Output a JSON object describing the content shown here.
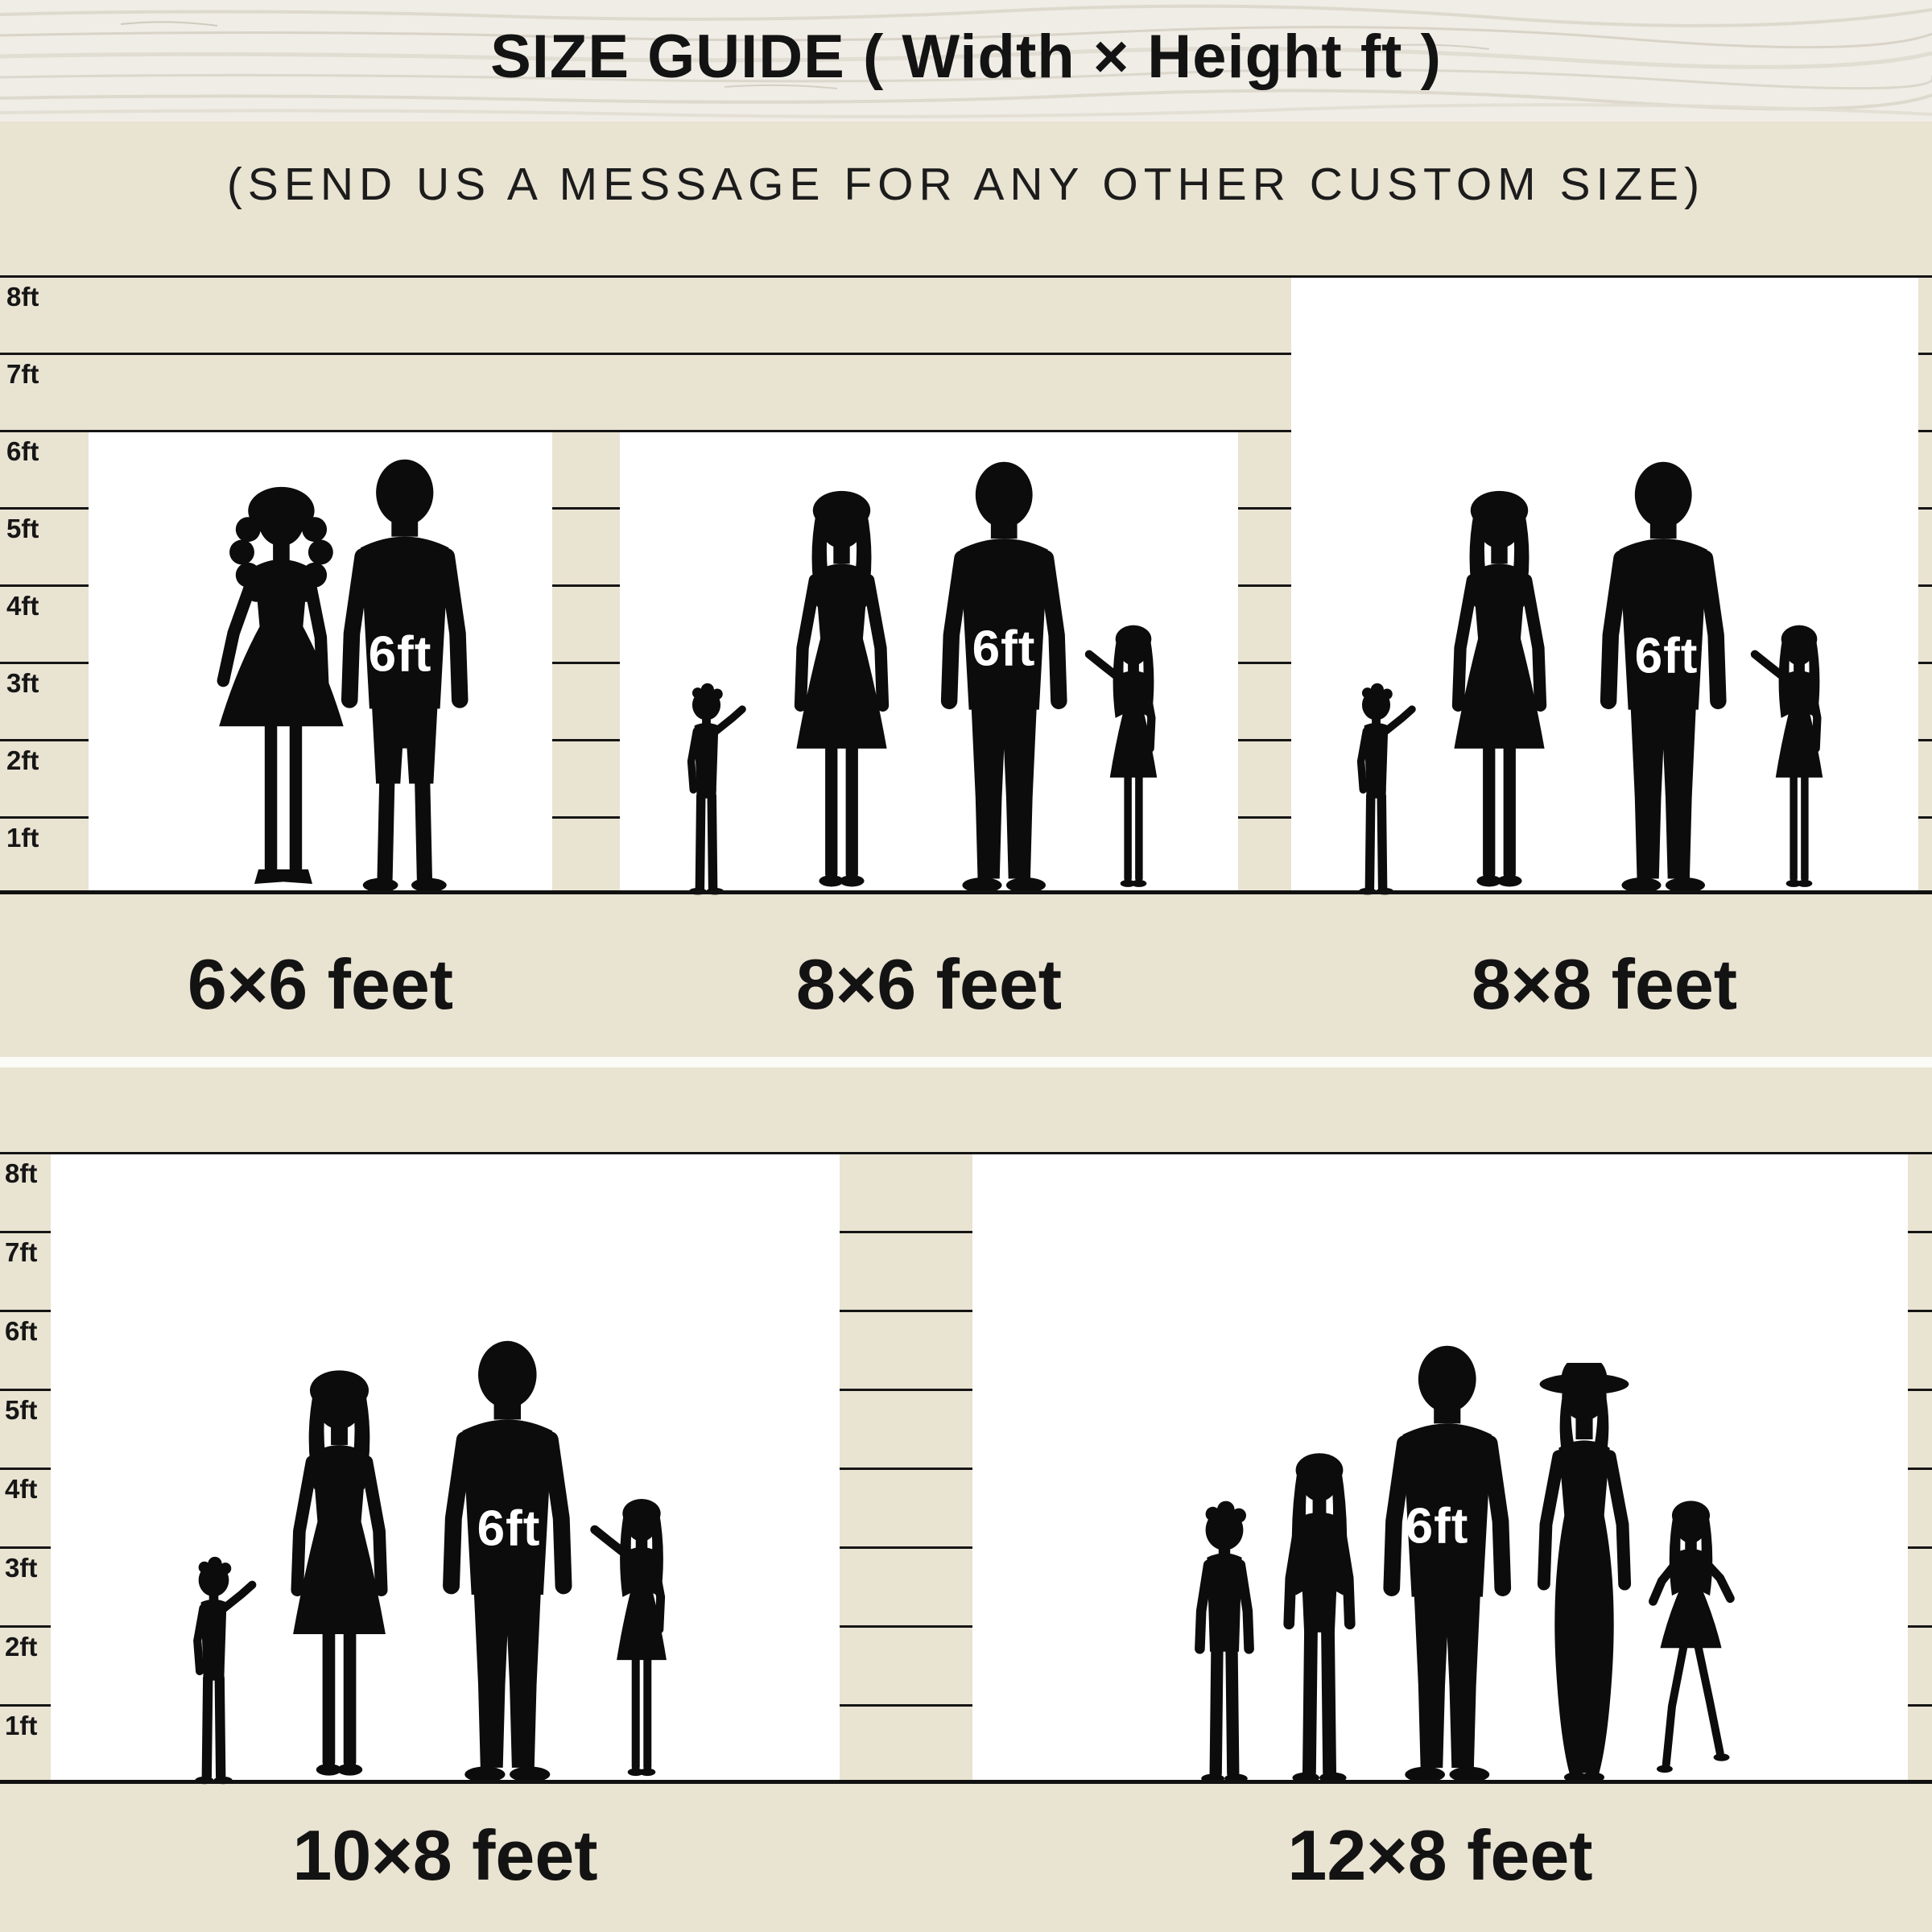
{
  "header": {
    "title": "SIZE GUIDE ( Width × Height ft )"
  },
  "note": "(SEND US A MESSAGE FOR ANY OTHER CUSTOM SIZE)",
  "ruler": {
    "unit": "ft",
    "ticks": [
      "8ft",
      "7ft",
      "6ft",
      "5ft",
      "4ft",
      "3ft",
      "2ft",
      "1ft"
    ]
  },
  "sizes": [
    {
      "label": "6×6 feet",
      "width_ft": 6,
      "height_ft": 6,
      "marker": "6ft",
      "figures": "couple"
    },
    {
      "label": "8×6 feet",
      "width_ft": 8,
      "height_ft": 6,
      "marker": "6ft",
      "figures": "family of four"
    },
    {
      "label": "8×8 feet",
      "width_ft": 8,
      "height_ft": 8,
      "marker": "6ft",
      "figures": "family of four"
    },
    {
      "label": "10×8 feet",
      "width_ft": 10,
      "height_ft": 8,
      "marker": "6ft",
      "figures": "family of four"
    },
    {
      "label": "12×8 feet",
      "width_ft": 12,
      "height_ft": 8,
      "marker": "6ft",
      "figures": "family of five"
    }
  ],
  "colors": {
    "background": "#e9e3d2",
    "panel": "#ffffff",
    "grid_line": "#151515",
    "silhouette": "#0c0c0c",
    "marker_text": "#ffffff",
    "divider": "#fbfbf8",
    "wood_base": "#f0ede6",
    "wood_streak": "#cfc8bb",
    "text": "#121212"
  }
}
